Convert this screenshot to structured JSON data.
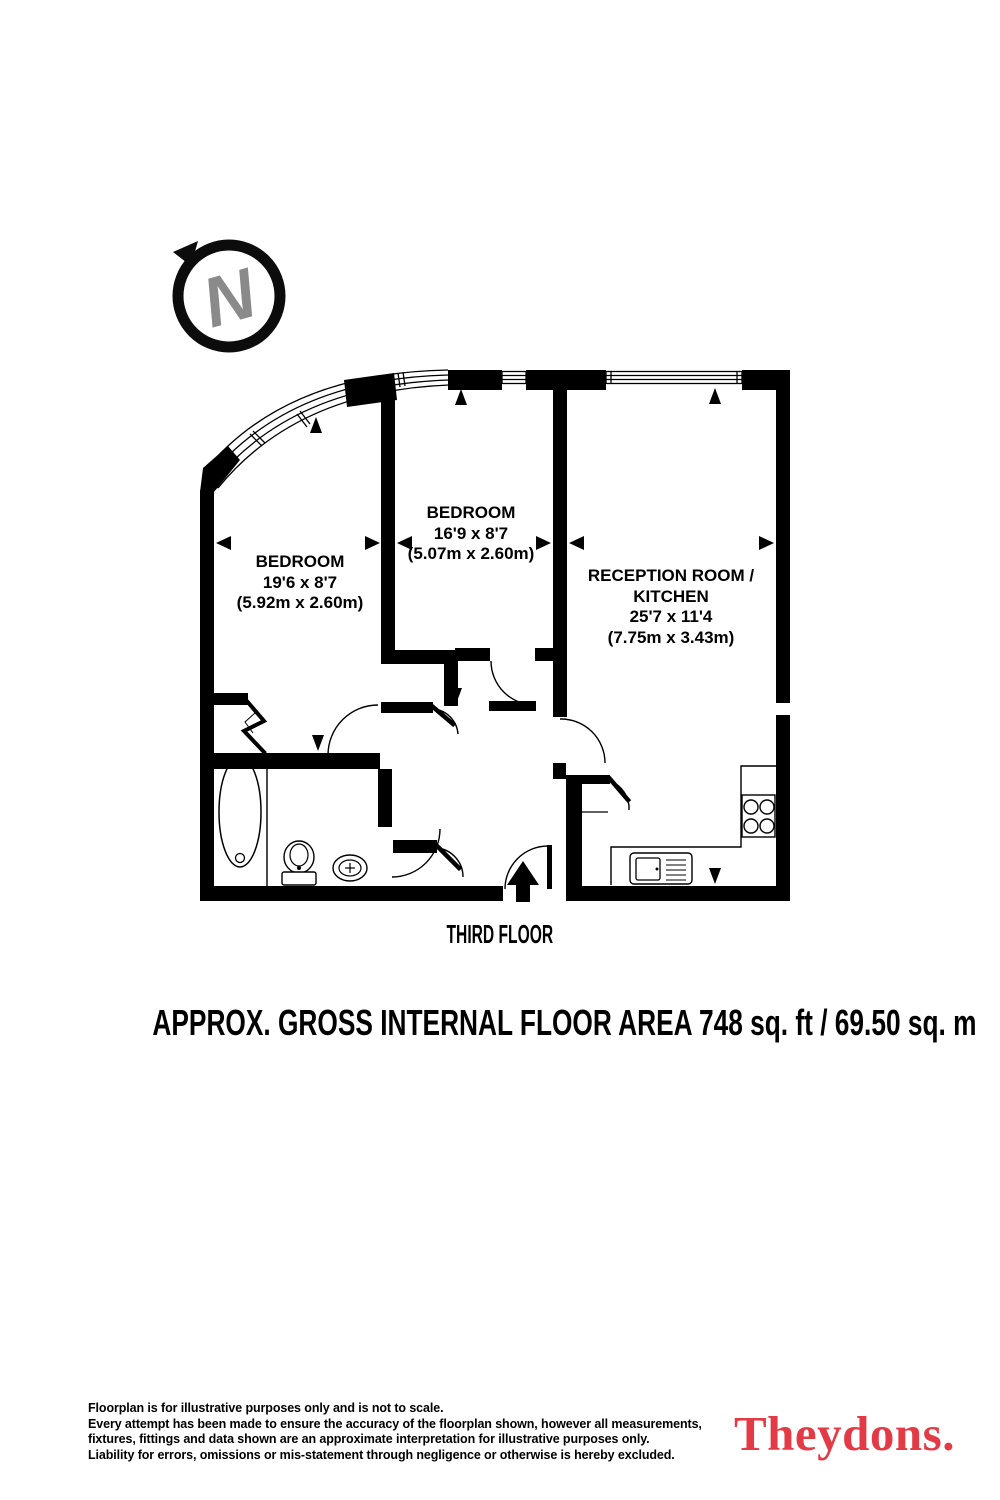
{
  "compass": {
    "letter": "N"
  },
  "plan": {
    "floor_label": "THIRD FLOOR",
    "rooms": [
      {
        "lines": [
          "BEDROOM",
          "19'6 x 8'7",
          "(5.92m x 2.60m)"
        ]
      },
      {
        "lines": [
          "BEDROOM",
          "16'9 x 8'7",
          "(5.07m x 2.60m)"
        ]
      },
      {
        "lines": [
          "RECEPTION ROOM /",
          "KITCHEN",
          "25'7 x 11'4",
          "(7.75m x 3.43m)"
        ]
      }
    ]
  },
  "area_summary": "APPROX. GROSS INTERNAL FLOOR AREA 748 sq. ft / 69.50 sq. m",
  "disclaimer": {
    "line1": "Floorplan is for illustrative purposes only and is not to scale.",
    "line2": "Every attempt has been made to ensure the accuracy of the floorplan shown, however all measurements,",
    "line3": "fixtures, fittings and data shown are an approximate interpretation for illustrative purposes only.",
    "line4": "Liability for errors, omissions or mis-statement through negligence or otherwise is hereby excluded."
  },
  "brand": {
    "name": "Theydons.",
    "color": "#e23b45",
    "wall_color": "#000000",
    "compass_letter_color": "#8a8a8a"
  }
}
